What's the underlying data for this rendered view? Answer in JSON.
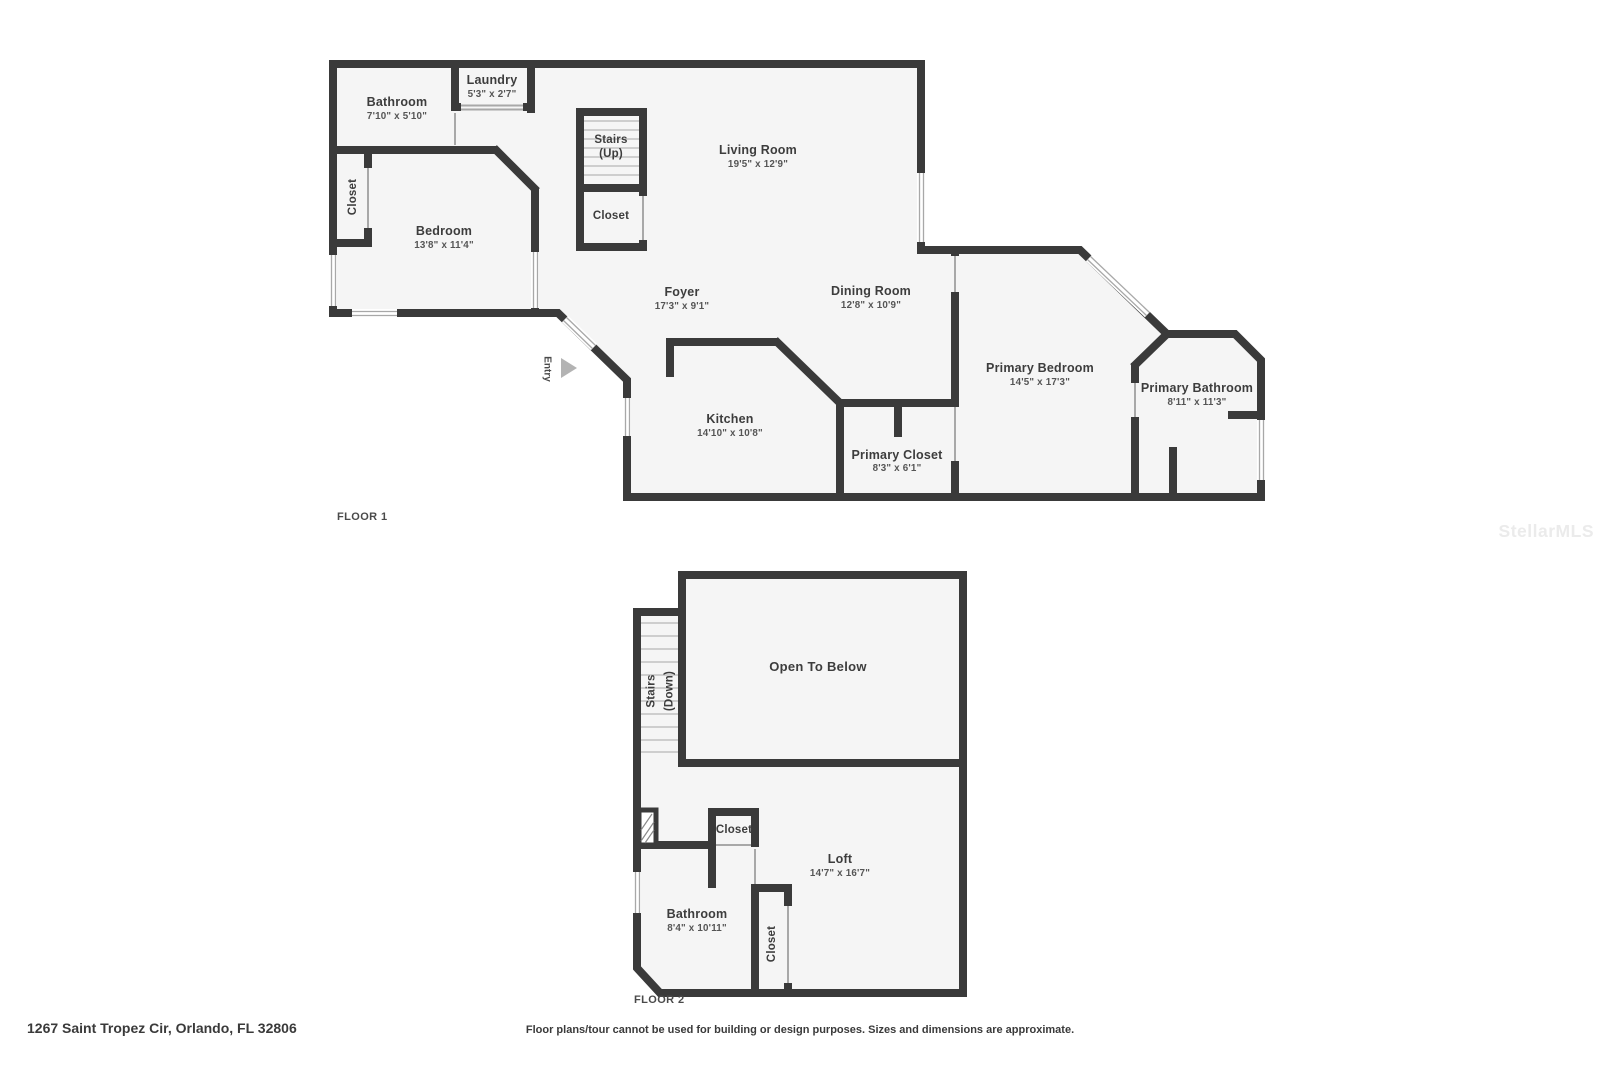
{
  "colors": {
    "wall": "#3a3a3a",
    "floor_fill": "#f5f5f5",
    "open_below_fill": "#eaeaea",
    "background": "#ffffff"
  },
  "watermark": "StellarMLS",
  "footer": {
    "address": "1267 Saint Tropez Cir, Orlando, FL 32806",
    "disclaimer": "Floor plans/tour cannot be used for building or design purposes. Sizes and dimensions are approximate."
  },
  "floor1": {
    "label": "FLOOR 1",
    "rooms": {
      "bathroom": {
        "name": "Bathroom",
        "dims": "7'10\" x 5'10\""
      },
      "laundry": {
        "name": "Laundry",
        "dims": "5'3\" x 2'7\""
      },
      "stairs": {
        "name": "Stairs",
        "sub": "(Up)"
      },
      "stairs_closet": {
        "name": "Closet"
      },
      "living": {
        "name": "Living Room",
        "dims": "19'5\" x 12'9\""
      },
      "bedroom_closet": {
        "name": "Closet"
      },
      "bedroom": {
        "name": "Bedroom",
        "dims": "13'8\" x 11'4\""
      },
      "foyer": {
        "name": "Foyer",
        "dims": "17'3\" x 9'1\""
      },
      "dining": {
        "name": "Dining Room",
        "dims": "12'8\" x 10'9\""
      },
      "entry": {
        "name": "Entry"
      },
      "kitchen": {
        "name": "Kitchen",
        "dims": "14'10\" x 10'8\""
      },
      "primary_closet": {
        "name": "Primary Closet",
        "dims": "8'3\" x 6'1\""
      },
      "primary_bedroom": {
        "name": "Primary Bedroom",
        "dims": "14'5\" x 17'3\""
      },
      "primary_bathroom": {
        "name": "Primary Bathroom",
        "dims": "8'11\" x 11'3\""
      }
    }
  },
  "floor2": {
    "label": "FLOOR 2",
    "rooms": {
      "stairs": {
        "name": "Stairs",
        "sub": "(Down)"
      },
      "open_below": {
        "name": "Open To Below"
      },
      "closet_top": {
        "name": "Closet"
      },
      "loft": {
        "name": "Loft",
        "dims": "14'7\" x 16'7\""
      },
      "bathroom": {
        "name": "Bathroom",
        "dims": "8'4\" x 10'11\""
      },
      "closet_tall": {
        "name": "Closet"
      }
    }
  }
}
